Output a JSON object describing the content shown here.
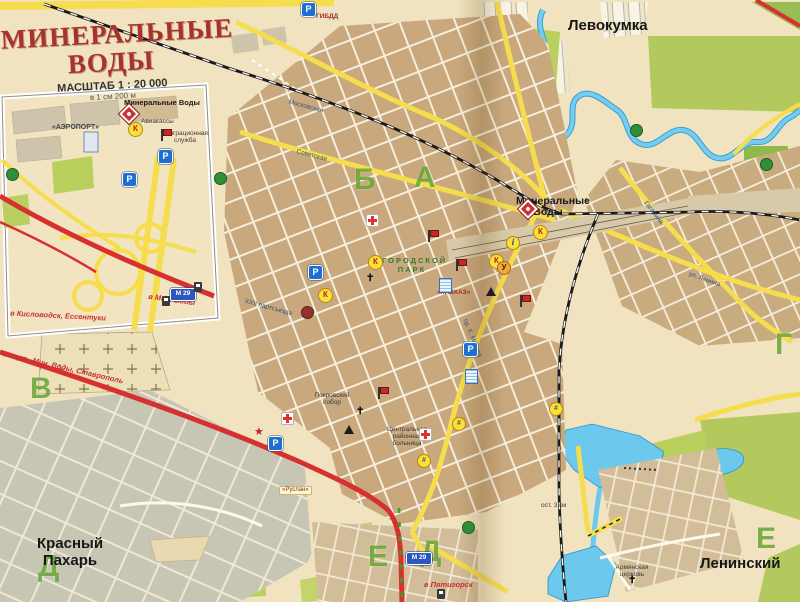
{
  "title_block": {
    "line1": "МИНЕРАЛЬНЫЕ",
    "line2": "ВОДЫ",
    "scale": "МАСШТАБ 1 : 20 000",
    "scale_note": "в 1 см 200 м"
  },
  "places": {
    "levokumka": "Левокумка",
    "krasny_pahar_1": "Красный",
    "krasny_pahar_2": "Пахарь",
    "leninsky": "Ленинский",
    "station_1": "Минеральные",
    "station_2": "Воды",
    "park_1": "ГОРОДСКОЙ",
    "park_2": "ПАРК",
    "hotel_kavkaz": "«КАВКАЗ»",
    "hospital": "Центральная районная больница",
    "cathedral": "Покровский собор",
    "armenian_church_1": "Армянская",
    "armenian_church_2": "церковь",
    "gibdd": "ГИБДД",
    "ruslan": "«Руслан»",
    "bus_stop": "ост. 3 км",
    "aviakassy": "Авиакассы"
  },
  "inset": {
    "station": "Минеральные Воды",
    "airport": "«АЭРОПОРТ»",
    "migration_1": "Миграционная",
    "migration_2": "служба",
    "to_kislovodsk": "в Кисловодск, Ессентуки",
    "to_stavropol": "в аэрп., Мин. Воды, Ставрополь",
    "to_minvody": "в Мин. Воды"
  },
  "road_labels": {
    "to_pyatigorsk": "в Пятигорск",
    "m29": "М 29"
  },
  "streets": [
    {
      "name": "Советская"
    },
    {
      "name": "Московская"
    },
    {
      "name": "пр. К. Маркса"
    },
    {
      "name": "ул. Ленина"
    },
    {
      "name": "Гагарина"
    },
    {
      "name": "XXII партсъезда"
    }
  ],
  "grid_letters": [
    {
      "ch": "А"
    },
    {
      "ch": "Б"
    },
    {
      "ch": "В"
    },
    {
      "ch": "Г"
    },
    {
      "ch": "Д"
    },
    {
      "ch": "Е"
    },
    {
      "ch": "Д"
    },
    {
      "ch": "Е"
    }
  ],
  "icons": {
    "parking": "P",
    "kiosk": "К",
    "info": "і",
    "service": "У",
    "church": "✝",
    "star": "★",
    "market": "#"
  },
  "colors": {
    "main_road": "#f5dd4e",
    "highway": "#d63030",
    "water": "#6cc8ec",
    "park_green": "#b9d05e",
    "block_tan": "#c8a87c",
    "grid_letter_green": "#5a9e28",
    "title_red": "#a8322c"
  }
}
